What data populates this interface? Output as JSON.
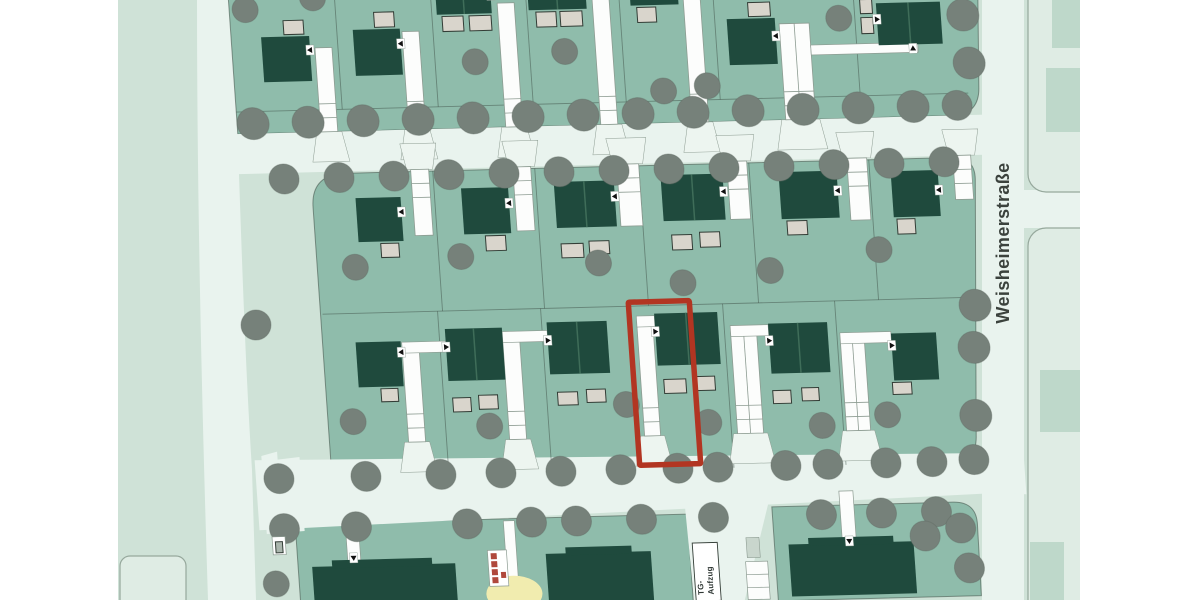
{
  "labels": {
    "street_name": "Weisheimerstraße",
    "tg_line1": "TG-",
    "tg_line2": "Aufzug"
  },
  "colors": {
    "white": "#ffffff",
    "field": "#cfe2d7",
    "street": "#e9f3ee",
    "flare": "#edf5f0",
    "estate": "#8fbcab",
    "roof": "#1f4a3d",
    "roof_divider": "#3f6d59",
    "garage_fill": "#d9d5cc",
    "garage_stroke": "#333d36",
    "tree": "#76817a",
    "tree_stroke": "#5f6a62",
    "terracotta": "#c5846b",
    "parcel": "#dfece4",
    "parcel_stroke": "#96a89c",
    "faded_building": "#bed8ca",
    "boundary": "#3e4e45",
    "driveway_fill": "#fcfdfc",
    "driveway_stroke": "#8d9c92",
    "highlight_red": "#b23522",
    "marker_black": "#111111",
    "yellow": "#f1ecaf",
    "stair_red": "#b0483c",
    "text_dark": "#3b423d"
  },
  "base": {
    "field": {
      "x": 118,
      "y": 0,
      "w": 962,
      "h": 600
    },
    "left_street_path": "M197,0 L233,0 C239,160 243,330 252,470 L256,600 L208,600 C201,380 197,180 197,0 Z",
    "right_street": {
      "x": 982,
      "y": 0,
      "w": 42,
      "h": 600
    },
    "cross_street": {
      "x": 1022,
      "y": 190,
      "w": 58,
      "h": 38
    },
    "parcels": [
      {
        "x": 1028,
        "y": -20,
        "w": 140,
        "h": 212,
        "r": 18
      },
      {
        "x": 1028,
        "y": 228,
        "w": 140,
        "h": 392,
        "r": 18
      },
      {
        "x": 120,
        "y": 556,
        "w": 66,
        "h": 60,
        "r": 10
      }
    ],
    "faded_buildings": [
      {
        "x": 1052,
        "y": 0,
        "w": 28,
        "h": 48
      },
      {
        "x": 1046,
        "y": 68,
        "w": 34,
        "h": 64
      },
      {
        "x": 1040,
        "y": 370,
        "w": 40,
        "h": 62
      },
      {
        "x": 1030,
        "y": 542,
        "w": 34,
        "h": 58
      }
    ],
    "bg_trees": [
      [
        256,
        325,
        15
      ]
    ],
    "white_margins": [
      {
        "x": 0,
        "y": 0,
        "w": 118,
        "h": 600
      },
      {
        "x": 1080,
        "y": 0,
        "w": 120,
        "h": 600
      }
    ],
    "street_label_pos": {
      "x": 1009,
      "y": 243,
      "rotate": -90
    }
  },
  "estate": {
    "transform": "matrix(1,-0.026,0.07,1,0,0)",
    "blocks": [
      {
        "name": "row1-block",
        "path": "M228,-40 L980,-40 L971,112 Q970,138 946,140 L228,140 Z"
      },
      {
        "name": "row23-block",
        "path": "M298,215 Q298,186 326,182 L940,182 Q962,182 961,204 L944,460 Q943,486 918,486 L298,486 Z"
      },
      {
        "name": "bottom-left-block",
        "path": "M258,531 L650,531 L650,620 L258,620 Z"
      },
      {
        "name": "bottom-right-block",
        "path": "M735,526 L916,526 Q940,526 939,550 L938,620 L735,620 Z"
      }
    ],
    "streets": [
      {
        "name": "street-between-row1-row2",
        "path": "M200,140 L985,140 L985,180 L200,180 Z"
      },
      {
        "name": "bottom-street",
        "path": "M222,466 L960,478 L990,486 L990,520 L960,518 L222,536 Z"
      },
      {
        "name": "street-wedge",
        "path": "M229,462 L245,458 L245,466 L267,464 L267,538 L229,540 Z"
      },
      {
        "name": "tg-ramp",
        "path": "M648,512 L735,512 L701,620 L651,620 Z"
      }
    ],
    "boundary_lines": [
      [
        228,
        118,
        960,
        118
      ],
      [
        300,
        322,
        948,
        322
      ]
    ],
    "plot_lines": [
      [
        334,
        -20,
        334,
        118
      ],
      [
        430,
        -20,
        430,
        118
      ],
      [
        525,
        -20,
        525,
        118
      ],
      [
        618,
        -20,
        618,
        118
      ],
      [
        712,
        -20,
        712,
        118
      ],
      [
        852,
        -20,
        852,
        118
      ],
      [
        420,
        182,
        420,
        322
      ],
      [
        522,
        182,
        522,
        322
      ],
      [
        626,
        182,
        626,
        322
      ],
      [
        736,
        182,
        736,
        322
      ],
      [
        856,
        182,
        856,
        322
      ],
      [
        415,
        322,
        415,
        486
      ],
      [
        518,
        322,
        518,
        486
      ],
      [
        700,
        322,
        700,
        486
      ],
      [
        812,
        322,
        812,
        486
      ]
    ],
    "driveways": [
      {
        "x": 311,
        "y": 56,
        "w": 17,
        "h": 84,
        "f": "d"
      },
      {
        "x": 399,
        "y": 42,
        "w": 17,
        "h": 98,
        "f": "d"
      },
      {
        "x": 496,
        "y": 16,
        "w": 17,
        "h": 124,
        "f": "d"
      },
      {
        "x": 591,
        "y": 12,
        "w": 17,
        "h": 128,
        "f": "d"
      },
      {
        "x": 682,
        "y": 10,
        "w": 17,
        "h": 130,
        "f": "d"
      },
      {
        "x": 776,
        "y": 44,
        "w": 30,
        "h": 96,
        "f": "d"
      },
      {
        "x": 398,
        "y": 180,
        "w": 18,
        "h": 66,
        "f": "u"
      },
      {
        "x": 500,
        "y": 180,
        "w": 18,
        "h": 64,
        "f": "u"
      },
      {
        "x": 604,
        "y": 180,
        "w": 22,
        "h": 62,
        "f": "u"
      },
      {
        "x": 714,
        "y": 180,
        "w": 20,
        "h": 58,
        "f": "u"
      },
      {
        "x": 834,
        "y": 180,
        "w": 20,
        "h": 62,
        "f": "u"
      },
      {
        "x": 940,
        "y": 180,
        "w": 18,
        "h": 44,
        "f": "u"
      },
      {
        "x": 377,
        "y": 360,
        "w": 17,
        "h": 92,
        "f": "d"
      },
      {
        "x": 478,
        "y": 350,
        "w": 17,
        "h": 102,
        "f": "d"
      },
      {
        "x": 613,
        "y": 338,
        "w": 16,
        "h": 114,
        "f": "d"
      },
      {
        "x": 706,
        "y": 350,
        "w": 26,
        "h": 102,
        "f": "d"
      },
      {
        "x": 815,
        "y": 360,
        "w": 24,
        "h": 92,
        "f": "d"
      }
    ],
    "paths": [
      {
        "x": 806,
        "y": 66,
        "w": 107,
        "h": 10
      },
      {
        "x": 377,
        "y": 352,
        "w": 44,
        "h": 11
      },
      {
        "x": 478,
        "y": 344,
        "w": 45,
        "h": 11
      },
      {
        "x": 613,
        "y": 332,
        "w": 18,
        "h": 11
      },
      {
        "x": 706,
        "y": 344,
        "w": 38,
        "h": 11
      },
      {
        "x": 815,
        "y": 354,
        "w": 51,
        "h": 11
      },
      {
        "x": 308,
        "y": 534,
        "w": 13,
        "h": 38
      },
      {
        "x": 466,
        "y": 533,
        "w": 11,
        "h": 66
      },
      {
        "x": 803,
        "y": 512,
        "w": 14,
        "h": 54
      }
    ],
    "houses": [
      {
        "x": 258,
        "y": 44,
        "w": 48,
        "h": 45,
        "split": false
      },
      {
        "x": 350,
        "y": 39,
        "w": 47,
        "h": 46,
        "split": false
      },
      {
        "x": 435,
        "y": -18,
        "w": 55,
        "h": 44,
        "split": true
      },
      {
        "x": 527,
        "y": -20,
        "w": 58,
        "h": 44,
        "split": true
      },
      {
        "x": 629,
        "y": -22,
        "w": 48,
        "h": 44,
        "split": false
      },
      {
        "x": 724,
        "y": 38,
        "w": 48,
        "h": 46,
        "split": false
      },
      {
        "x": 874,
        "y": 26,
        "w": 64,
        "h": 42,
        "split": true
      },
      {
        "x": 341,
        "y": 207,
        "w": 45,
        "h": 44,
        "split": false
      },
      {
        "x": 447,
        "y": 200,
        "w": 47,
        "h": 46,
        "split": false
      },
      {
        "x": 540,
        "y": 196,
        "w": 60,
        "h": 46,
        "split": true
      },
      {
        "x": 647,
        "y": 192,
        "w": 62,
        "h": 46,
        "split": true
      },
      {
        "x": 765,
        "y": 192,
        "w": 58,
        "h": 47,
        "split": false
      },
      {
        "x": 877,
        "y": 194,
        "w": 47,
        "h": 46,
        "split": false
      },
      {
        "x": 331,
        "y": 351,
        "w": 45,
        "h": 45,
        "split": false
      },
      {
        "x": 421,
        "y": 340,
        "w": 57,
        "h": 52,
        "split": true
      },
      {
        "x": 523,
        "y": 336,
        "w": 60,
        "h": 52,
        "split": true
      },
      {
        "x": 631,
        "y": 330,
        "w": 63,
        "h": 52,
        "split": true
      },
      {
        "x": 744,
        "y": 343,
        "w": 59,
        "h": 50,
        "split": true
      },
      {
        "x": 866,
        "y": 356,
        "w": 45,
        "h": 47,
        "split": false
      }
    ],
    "garages": [
      {
        "x": 281,
        "y": 28,
        "w": 20,
        "h": 14
      },
      {
        "x": 372,
        "y": 22,
        "w": 20,
        "h": 15
      },
      {
        "x": 440,
        "y": 28,
        "w": 21,
        "h": 15
      },
      {
        "x": 467,
        "y": 28,
        "w": 22,
        "h": 15
      },
      {
        "x": 534,
        "y": 26,
        "w": 20,
        "h": 15
      },
      {
        "x": 558,
        "y": 26,
        "w": 22,
        "h": 15
      },
      {
        "x": 635,
        "y": 24,
        "w": 19,
        "h": 15
      },
      {
        "x": 746,
        "y": 22,
        "w": 22,
        "h": 14
      },
      {
        "x": 858,
        "y": 22,
        "w": 12,
        "h": 14
      },
      {
        "x": 858,
        "y": 40,
        "w": 12,
        "h": 16
      },
      {
        "x": 363,
        "y": 253,
        "w": 18,
        "h": 14
      },
      {
        "x": 468,
        "y": 248,
        "w": 20,
        "h": 15
      },
      {
        "x": 543,
        "y": 258,
        "w": 22,
        "h": 14
      },
      {
        "x": 571,
        "y": 256,
        "w": 20,
        "h": 13
      },
      {
        "x": 654,
        "y": 252,
        "w": 20,
        "h": 15
      },
      {
        "x": 682,
        "y": 250,
        "w": 20,
        "h": 15
      },
      {
        "x": 770,
        "y": 241,
        "w": 20,
        "h": 14
      },
      {
        "x": 880,
        "y": 242,
        "w": 18,
        "h": 15
      },
      {
        "x": 353,
        "y": 398,
        "w": 17,
        "h": 13
      },
      {
        "x": 424,
        "y": 409,
        "w": 18,
        "h": 14
      },
      {
        "x": 450,
        "y": 407,
        "w": 19,
        "h": 14
      },
      {
        "x": 529,
        "y": 406,
        "w": 20,
        "h": 13
      },
      {
        "x": 558,
        "y": 404,
        "w": 19,
        "h": 13
      },
      {
        "x": 636,
        "y": 396,
        "w": 22,
        "h": 14
      },
      {
        "x": 667,
        "y": 394,
        "w": 20,
        "h": 14
      },
      {
        "x": 744,
        "y": 410,
        "w": 18,
        "h": 13
      },
      {
        "x": 773,
        "y": 408,
        "w": 17,
        "h": 13
      },
      {
        "x": 864,
        "y": 405,
        "w": 19,
        "h": 12
      }
    ],
    "buildings": [
      {
        "x": 272,
        "y": 574,
        "w": 143,
        "h": 46
      },
      {
        "x": 292,
        "y": 568,
        "w": 100,
        "h": 8
      },
      {
        "x": 506,
        "y": 567,
        "w": 105,
        "h": 50
      },
      {
        "x": 526,
        "y": 561,
        "w": 66,
        "h": 8
      },
      {
        "x": 749,
        "y": 564,
        "w": 125,
        "h": 52
      },
      {
        "x": 769,
        "y": 558,
        "w": 85,
        "h": 8
      }
    ],
    "markers": [
      [
        306,
        58,
        "l"
      ],
      [
        397,
        54,
        "l"
      ],
      [
        490,
        8,
        "l"
      ],
      [
        585,
        6,
        "l"
      ],
      [
        677,
        8,
        "l"
      ],
      [
        772,
        56,
        "l"
      ],
      [
        874,
        42,
        "r"
      ],
      [
        908,
        72,
        "u"
      ],
      [
        386,
        222,
        "l"
      ],
      [
        494,
        216,
        "l"
      ],
      [
        600,
        212,
        "l"
      ],
      [
        709,
        210,
        "l"
      ],
      [
        823,
        212,
        "l"
      ],
      [
        924,
        214,
        "l"
      ],
      [
        421,
        358,
        "r"
      ],
      [
        523,
        354,
        "r"
      ],
      [
        631,
        348,
        "r"
      ],
      [
        744,
        360,
        "r"
      ],
      [
        866,
        368,
        "r"
      ],
      [
        376,
        362,
        "l"
      ],
      [
        314,
        566,
        "d"
      ],
      [
        471,
        594,
        "d"
      ],
      [
        810,
        562,
        "d"
      ]
    ],
    "trees": [
      [
        244,
        130,
        16
      ],
      [
        299,
        130,
        16
      ],
      [
        354,
        130,
        16
      ],
      [
        409,
        130,
        16
      ],
      [
        464,
        130,
        16
      ],
      [
        519,
        130,
        16
      ],
      [
        574,
        130,
        16
      ],
      [
        629,
        130,
        16
      ],
      [
        684,
        130,
        16
      ],
      [
        739,
        130,
        16
      ],
      [
        794,
        130,
        16
      ],
      [
        849,
        130,
        16
      ],
      [
        904,
        130,
        16
      ],
      [
        948,
        130,
        15
      ],
      [
        271,
        186,
        15
      ],
      [
        326,
        186,
        15
      ],
      [
        381,
        186,
        15
      ],
      [
        436,
        186,
        15
      ],
      [
        491,
        186,
        15
      ],
      [
        546,
        186,
        15
      ],
      [
        601,
        186,
        15
      ],
      [
        656,
        186,
        15
      ],
      [
        711,
        186,
        15
      ],
      [
        766,
        186,
        15
      ],
      [
        821,
        186,
        15
      ],
      [
        876,
        186,
        15
      ],
      [
        931,
        186,
        15
      ],
      [
        244,
        16,
        13
      ],
      [
        312,
        6,
        13
      ],
      [
        470,
        74,
        13
      ],
      [
        560,
        66,
        13
      ],
      [
        656,
        108,
        13
      ],
      [
        700,
        104,
        13
      ],
      [
        836,
        40,
        13
      ],
      [
        336,
        276,
        13
      ],
      [
        442,
        268,
        13
      ],
      [
        579,
        278,
        13
      ],
      [
        750,
        290,
        13
      ],
      [
        860,
        272,
        13
      ],
      [
        662,
        300,
        13
      ],
      [
        323,
        430,
        13
      ],
      [
        459,
        438,
        13
      ],
      [
        597,
        420,
        13
      ],
      [
        678,
        440,
        13
      ],
      [
        791,
        446,
        13
      ],
      [
        857,
        437,
        13
      ],
      [
        960,
        40,
        16
      ],
      [
        963,
        88,
        16
      ],
      [
        952,
        330,
        16
      ],
      [
        948,
        372,
        16
      ],
      [
        945,
        440,
        16
      ],
      [
        940,
        484,
        15
      ],
      [
        245,
        485,
        15
      ],
      [
        332,
        485,
        15
      ],
      [
        407,
        485,
        15
      ],
      [
        467,
        485,
        15
      ],
      [
        527,
        485,
        15
      ],
      [
        587,
        485,
        15
      ],
      [
        644,
        485,
        15
      ],
      [
        684,
        485,
        15
      ],
      [
        752,
        485,
        15
      ],
      [
        794,
        485,
        15
      ],
      [
        852,
        485,
        15
      ],
      [
        898,
        485,
        15
      ],
      [
        247,
        535,
        15
      ],
      [
        319,
        535,
        15
      ],
      [
        430,
        535,
        15
      ],
      [
        494,
        535,
        15
      ],
      [
        539,
        535,
        15
      ],
      [
        604,
        535,
        15
      ],
      [
        676,
        535,
        15
      ],
      [
        784,
        535,
        15
      ],
      [
        844,
        535,
        15
      ],
      [
        899,
        535,
        15
      ],
      [
        886,
        559,
        15
      ],
      [
        922,
        552,
        15
      ],
      [
        928,
        592,
        15
      ],
      [
        235,
        590,
        13
      ]
    ],
    "red_plot": {
      "x": 606,
      "y": 318,
      "w": 61,
      "h": 163
    },
    "tg_box": {
      "x": 653,
      "y": 560,
      "w": 25,
      "h": 58
    },
    "tg_small": {
      "x": 707,
      "y": 556,
      "w": 13,
      "h": 20
    },
    "tg_parking": {
      "x": 705,
      "y": 580,
      "w": 22,
      "h": 38
    },
    "stair_box": {
      "x": 448,
      "y": 562,
      "w": 19,
      "h": 36,
      "squares": [
        [
          451,
          565
        ],
        [
          451,
          573
        ],
        [
          451,
          581
        ],
        [
          451,
          589
        ]
      ],
      "small": [
        460,
        584
      ]
    },
    "entry_box": {
      "x": 234,
      "y": 543,
      "w": 13,
      "h": 18,
      "inner": {
        "x": 237,
        "y": 548,
        "w": 7,
        "h": 11
      }
    },
    "yellow_area": {
      "cx": 472,
      "cy": 606,
      "rx": 28,
      "ry": 18
    },
    "tg_text_pos": {
      "x1": 661,
      "x2": 671,
      "y": 612
    }
  }
}
